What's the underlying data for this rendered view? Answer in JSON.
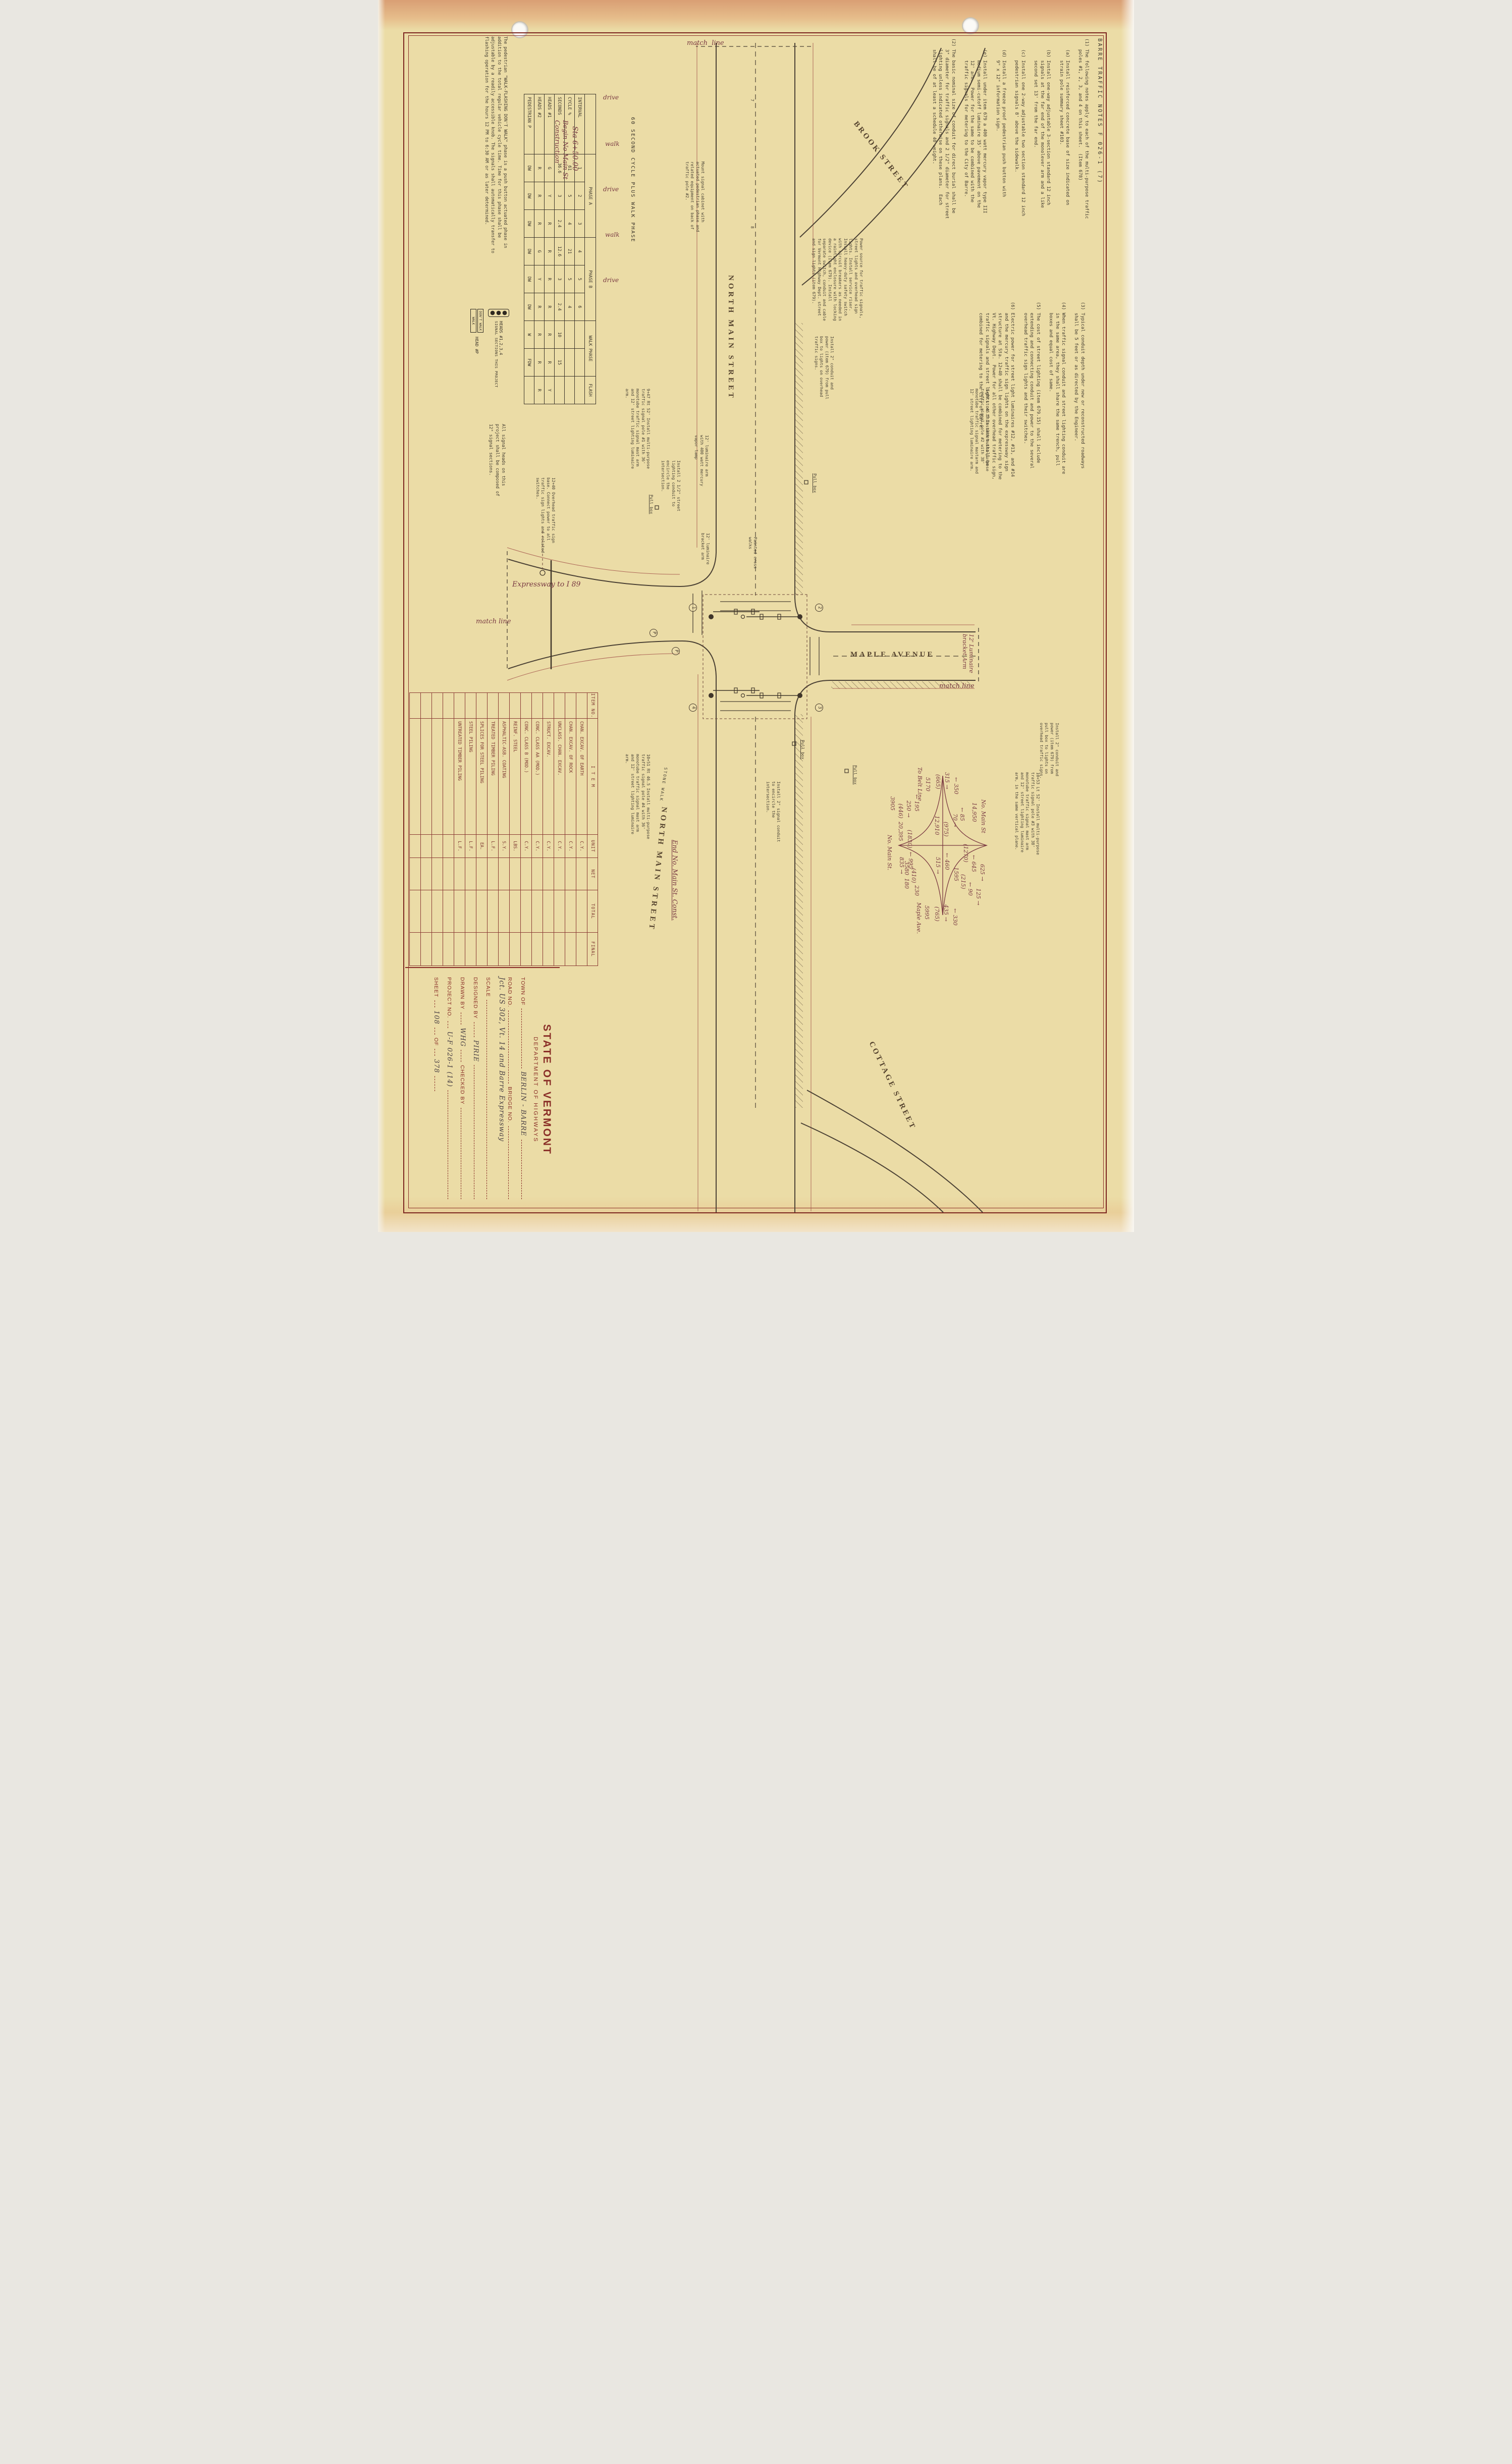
{
  "sheet": {
    "accent_maroon": "#8a2f28",
    "paper": "#ebdca6",
    "ink": "#433c30",
    "hand_ink": "#793a43"
  },
  "notes": {
    "title": "BARRE  TRAFFIC  NOTES        F 026-1 (7)",
    "col1": "(1) The following notes apply to each of the multi-purpose traffic\n    poles #1, 2, 3, and 4 on this sheet.  (Item 678)\n\n    (a) Install reinforced concrete base of size indicated on\n        strain pole summary sheet #103.\n\n    (b) Install one-way adjustable 3-section standard 12 inch\n        signals at the far end of the monolever arm and a like\n        second set 13' from the far end.\n\n    (c) Install one 2-way adjustable two section standard 12 inch\n        pedestrian signals 8' above the sidewalk.\n\n    (d) Install a freeze proof pedestrian push button with\n        9\" x 12\" information sign.\n\n    (e) Install under item 679 a 400 watt mercury vapor type III\n        medium semi-cutoff luminaire 35' above pavement on the\n        12' arm.  Power for the same to be combined with the\n        traffic signals for metering to the City of Barre.\n\n(2) The basic nominal size of conduit for direct burial shall be\n    3\" diameter for traffic signals and 2 1/2\" diameter for street\n    lighting unless indicated otherwise on these plans.  Each\n    shall be of at least a schedule 40 weight.",
    "col2": "(3) Typical conduit depth under new or reconstructed roadways\n    shall be 5 feet or as directed by the Engineer.\n\n(4) When traffic signal conduit and street lighting conduit are\n    in the same area, they shall share the same trench, pull\n    boxes and equal cost of same.\n\n(5) The cost of street lighting (item 679.15) shall include\n    extending and connecting conduit and power to the several\n    overhead traffic sign lights and their switches.\n\n(6) Electric power for street light luminaires #12, #13, and #14\n    and the mercury traffic sign lights on the expressway sign\n    structure at Sta. 12+40 shall be combined for metering to the\n    Vt. Highway Dept.  Power for all other overhead traffic sign,\n    traffic signals and street lights on this sheet shall be\n    combined for metering to the City of Barre."
  },
  "cycle_table": {
    "title": "60 SECOND CYCLE PLUS WALK PHASE",
    "groups": [
      "PHASE A",
      "PHASE B",
      "WALK PHASE",
      "FLASH"
    ],
    "row_labels": [
      "INTERVAL",
      "CYCLE %",
      "SECONDS",
      "HEADS #1",
      "HEADS #2",
      "PEDESTRIAN  P"
    ],
    "intervals": [
      "1",
      "2",
      "3",
      "4",
      "5",
      "6",
      "",
      "",
      ""
    ],
    "cycle_pct": [
      "61",
      "5",
      "4",
      "21",
      "5",
      "4",
      "",
      "",
      ""
    ],
    "seconds": [
      "36.6",
      "3",
      "2.4",
      "12.6",
      "3",
      "2.4",
      "10",
      "15",
      ""
    ],
    "heads1": [
      "G",
      "Y",
      "R",
      "R",
      "R",
      "R",
      "R",
      "R",
      "Y"
    ],
    "heads2": [
      "R",
      "R",
      "R",
      "G",
      "Y",
      "R",
      "R",
      "R",
      "R"
    ],
    "pedestrian": [
      "DW",
      "DW",
      "DW",
      "DW",
      "DW",
      "DW",
      "W",
      "FDW",
      ""
    ]
  },
  "ped_note": "The pedestrian \"WALK-FLASHING DON'T WALK\" phase is a push button actuated phase in addition to the total regular vehicle cycle time.  Time for this phase shall be adjustable by a readily accessible knob.  The signals shall automatically transfer to flashing operation for the hours 12 PM to 6:30 AM or as later determined.",
  "heads_note": "All signal heads on this project shall be composed of 12\" signal sections.",
  "legend": {
    "heads_label": "HEADS #1,2,3,4",
    "heads_sub": "SIGNAL SECTIONS THIS PROJECT",
    "dont_walk": "DON'T WALK",
    "walk": "WALK",
    "ped_label": "HEAD #P"
  },
  "items_table": {
    "headers": [
      "ITEM NO.",
      "I T E M",
      "UNIT",
      "NET",
      "TOTAL",
      "FINAL"
    ],
    "rows": [
      [
        "",
        "CHAN. EXCAV. OF EARTH",
        "C.Y.",
        "",
        "",
        ""
      ],
      [
        "",
        "CHAN. EXCAV. OF ROCK",
        "C.Y.",
        "",
        "",
        ""
      ],
      [
        "",
        "UNCLASS. CHAN. EXCAV.",
        "C.Y.",
        "",
        "",
        ""
      ],
      [
        "",
        "STRUCT. EXCAV.",
        "C.Y.",
        "",
        "",
        ""
      ],
      [
        "",
        "CONC. CLASS AA (MOD.)",
        "C.Y.",
        "",
        "",
        ""
      ],
      [
        "",
        "CONC. CLASS B (MOD.)",
        "C.Y.",
        "",
        "",
        ""
      ],
      [
        "",
        "REINF. STEEL",
        "LBS.",
        "",
        "",
        ""
      ],
      [
        "",
        "ASPHALTIC-ASB. COATING",
        "S.Y.",
        "",
        "",
        ""
      ],
      [
        "",
        "TREATED TIMBER PILING",
        "L.F.",
        "",
        "",
        ""
      ],
      [
        "",
        "SPLICES FOR STEEL PILING",
        "EA.",
        "",
        "",
        ""
      ],
      [
        "",
        "STEEL PILING",
        "L.F.",
        "",
        "",
        ""
      ],
      [
        "",
        "UNTREATED TIMBER PILING",
        "L.F.",
        "",
        "",
        ""
      ],
      [
        "",
        "",
        "",
        "",
        "",
        ""
      ],
      [
        "",
        "",
        "",
        "",
        "",
        ""
      ],
      [
        "",
        "",
        "",
        "",
        "",
        ""
      ],
      [
        "",
        "",
        "",
        "",
        "",
        ""
      ]
    ]
  },
  "title_block": {
    "state": "STATE OF VERMONT",
    "dept": "DEPARTMENT OF HIGHWAYS",
    "town_label": "TOWN OF",
    "town_value": "BERLIN - BARRE",
    "road_label": "ROAD NO.",
    "bridge_label": "BRIDGE NO.",
    "route_value": "Jct. US 302, Vt. 14 and Barre Expressway",
    "scale_label": "SCALE",
    "designed_label": "DESIGNED BY",
    "designed_value": "PIRIE",
    "drawn_label": "DRAWN BY",
    "drawn_value": "WHG",
    "checked_label": "CHECKED BY",
    "project_label": "PROJECT NO.",
    "project_value": "U-F 026-1 (14)",
    "sheet_label": "SHEET",
    "sheet_value": "108",
    "of_label": "OF",
    "total_sheets": "378"
  },
  "traffic_counts": {
    "legs": [
      {
        "name": "No. Main St",
        "adt": "14,950",
        "dhv": "(1270)",
        "flows": [
          "625",
          "645"
        ]
      },
      {
        "name": "Maple Ave.",
        "adt": "5995",
        "dhv": "(765)",
        "flows": [
          "330",
          "435"
        ]
      },
      {
        "name": "No. Main St.",
        "adt": "20,395",
        "dhv": "(1830)",
        "flows": [
          "995",
          "835"
        ]
      },
      {
        "name": "To Belt Line",
        "adt": "5170",
        "dhv": "(665)",
        "flows": [
          "350",
          "315"
        ]
      }
    ],
    "movements": [
      {
        "path": "through N-S",
        "values": [
          "460",
          "515",
          "(975)",
          "12,910"
        ]
      },
      {
        "path": "NE corner",
        "values": [
          "125",
          "90",
          "(215)",
          "1595"
        ]
      },
      {
        "path": "SE corner",
        "values": [
          "230",
          "180",
          "(410)",
          "3580"
        ]
      },
      {
        "path": "SW corner",
        "values": [
          "195",
          "250",
          "(446)",
          "3905"
        ]
      },
      {
        "path": "NW corner",
        "values": [
          "85",
          "70"
        ]
      }
    ]
  },
  "labels": [
    {
      "t": "BROOK STREET",
      "c": "street",
      "s": "left:225px;top:492px;transform:rotate(-38deg);letter-spacing:4px"
    },
    {
      "t": "NORTH MAIN STREET",
      "c": "street",
      "s": "left:545px;top:790px;letter-spacing:5px"
    },
    {
      "t": "NORTH MAIN STREET",
      "c": "street",
      "s": "left:1598px;top:935px;transform:rotate(6deg);letter-spacing:5px"
    },
    {
      "t": "MAPLE AVENUE",
      "c": "street",
      "s": "left:1288px;top:562px;transform:rotate(-90deg);transform-origin:0 0;letter-spacing:4px"
    },
    {
      "t": "COTTAGE STREET",
      "c": "street",
      "s": "left:2055px;top:470px;transform:rotate(-26deg);letter-spacing:4px"
    },
    {
      "t": "Expressway to I 89",
      "c": "hand",
      "s": "left:1150px;top:1232px;transform:rotate(-90deg);transform-origin:0 0;font-size:14px"
    },
    {
      "t": "match  line",
      "c": "hand",
      "s": "left:78px;top:886px;transform:rotate(-90deg);transform-origin:0 0;font-size:13px"
    },
    {
      "t": "match line",
      "c": "hand",
      "s": "left:1352px;top:386px;transform:rotate(-90deg);transform-origin:0 0;font-size:13px"
    },
    {
      "t": "match line",
      "c": "hand",
      "s": "left:1224px;top:1304px;transform:rotate(-90deg);transform-origin:0 0;font-size:13px"
    },
    {
      "t": "Sta 6+50.00",
      "c": "hand",
      "s": "left:250px;top:1100px;font-size:14px"
    },
    {
      "t": "Begin No Main St Construction",
      "c": "hand",
      "s": "left:238px;top:1120px;font-size:13px;width:170px;white-space:normal"
    },
    {
      "t": "End No. Main St. Const.",
      "c": "hand",
      "s": "left:1664px;top:903px;font-size:13px;text-decoration:underline"
    },
    {
      "t": "drive",
      "c": "hand",
      "s": "left:186px;top:1052px;transform:rotate(-90deg);transform-origin:0 0"
    },
    {
      "t": "walk",
      "c": "hand",
      "s": "left:278px;top:1048px;transform:rotate(-90deg);transform-origin:0 0"
    },
    {
      "t": "drive",
      "c": "hand",
      "s": "left:368px;top:1052px;transform:rotate(-90deg);transform-origin:0 0"
    },
    {
      "t": "walk",
      "c": "hand",
      "s": "left:458px;top:1048px;transform:rotate(-90deg);transform-origin:0 0"
    },
    {
      "t": "drive",
      "c": "hand",
      "s": "left:548px;top:1052px;transform:rotate(-90deg);transform-origin:0 0"
    },
    {
      "t": "12' Luminaire bracket Arm",
      "c": "hand",
      "s": "left:1256px;top:316px;width:88px;font-size:11px;white-space:normal;line-height:1.2"
    },
    {
      "t": "9+49 Lt 45.5  Install multi-purpose traffic signal pole #2 with 38' monotube traffic signal mastarm and 12' street lighting luminaire arm.",
      "c": "typed",
      "s": "left:770px;top:286px;width:172px"
    },
    {
      "t": "Install 2\" conduit and power (item 679) from pull box to lights on overhead traffic signs.",
      "c": "typed",
      "s": "left:1432px;top:148px;width:122px"
    },
    {
      "t": "10+53 Lt 52'  Install multi-purpose traffic signal pole #3 with 38' monotube traffic signal mast arm and 12' street lighting luminaire arm, in the same vertical plane.",
      "c": "typed",
      "s": "left:1530px;top:186px;width:172px"
    },
    {
      "t": "Power source for traffic signals, street lights and overhead sign lights. Install service riser. Install heavy-duty safety switch with circuit breakers as needed in a raintight enclosure with locking device (item 679). Install separate switch, conduit and cable for Vermont Highway Dept. street and sign lights (item 679).",
      "c": "typed",
      "s": "left:472px;top:536px;width:168px"
    },
    {
      "t": "Mount signal cabinet with actuated pedestrian phase and related equipment on back of traffic pole #2.",
      "c": "typed",
      "s": "left:320px;top:850px;width:162px"
    },
    {
      "t": "Install 2\" conduit and power (item 679) from pull box to lights on overhead traffic signs.",
      "c": "typed",
      "s": "left:666px;top:594px;width:130px"
    },
    {
      "t": "Install 2 1/2\" street lighting conduit to encircle the intersection.",
      "c": "typed",
      "s": "left:912px;top:898px;width:122px"
    },
    {
      "t": "Install 2\" signal conduit to encircle the intersection.",
      "c": "typed",
      "s": "left:1548px;top:700px;width:126px"
    },
    {
      "t": "9+47 Rt 52'  Install multi-purpose traffic signal pole #1 with 36' monotube traffic signal mast arm and 12' street lighting luminaire arm.",
      "c": "typed",
      "s": "left:770px;top:958px;width:172px"
    },
    {
      "t": "10+51 Rt 46.5  Install multi-purpose traffic signal pole #4 with 36' monotube traffic signal mast arm and 12' street lighting luminaire arm.",
      "c": "typed",
      "s": "left:1494px;top:958px;width:172px"
    },
    {
      "t": "12+40 Overhead traffic sign base.  Connect power to all traffic sign lights and related switches.",
      "c": "typed",
      "s": "left:946px;top:1146px;width:152px"
    },
    {
      "t": "Painted cross walks",
      "c": "typed",
      "s": "left:1064px;top:746px;width:64px"
    },
    {
      "t": "Pull box",
      "c": "typed",
      "s": "left:980px;top:952px;text-decoration:underline"
    },
    {
      "t": "Pull box",
      "c": "typed",
      "s": "left:938px;top:628px;text-decoration:underline"
    },
    {
      "t": "Pull box",
      "c": "typed",
      "s": "left:1516px;top:548px;text-decoration:underline"
    },
    {
      "t": "Pull box",
      "c": "typed",
      "s": "left:1466px;top:652px;text-decoration:underline"
    },
    {
      "t": "12' luminaire bracket arm",
      "c": "typed",
      "s": "left:1056px;top:840px;width:84px"
    },
    {
      "t": "12' luminaire arm with 400 watt mercury vapor lamp",
      "c": "typed",
      "s": "left:862px;top:842px;width:104px"
    },
    {
      "t": "STONE WALK",
      "c": "typed",
      "s": "left:1520px;top:928px;transform:rotate(8deg);letter-spacing:2px"
    },
    {
      "t": "7",
      "c": "typed",
      "s": "left:196px;top:752px"
    },
    {
      "t": "8",
      "c": "typed",
      "s": "left:448px;top:752px"
    },
    {
      "t": "2",
      "c": "circ",
      "s": "left:1196px;top:616px"
    },
    {
      "t": "1",
      "c": "circ",
      "s": "left:1196px;top:866px"
    },
    {
      "t": "3",
      "c": "circ",
      "s": "left:1394px;top:616px"
    },
    {
      "t": "4",
      "c": "circ",
      "s": "left:1394px;top:866px"
    },
    {
      "t": "P",
      "c": "circ",
      "s": "left:1282px;top:900px"
    },
    {
      "t": "P",
      "c": "circ",
      "s": "left:1246px;top:944px"
    },
    {
      "t": "No. Main St",
      "c": "hand",
      "s": "left:1584px;top:292px;font-size:11px"
    },
    {
      "t": "14,950",
      "c": "hand",
      "s": "left:1590px;top:310px;font-size:11px"
    },
    {
      "t": "625 →",
      "c": "hand",
      "s": "left:1712px;top:294px;font-size:11px"
    },
    {
      "t": "← 645",
      "c": "hand",
      "s": "left:1694px;top:311px;font-size:11px"
    },
    {
      "t": "(1270)",
      "c": "hand",
      "s": "left:1672px;top:327px;font-size:11px"
    },
    {
      "t": "← 460",
      "c": "hand",
      "s": "left:1690px;top:364px;font-size:11px"
    },
    {
      "t": "515 →",
      "c": "hand",
      "s": "left:1698px;top:382px;font-size:11px"
    },
    {
      "t": "(975)",
      "c": "hand",
      "s": "left:1628px;top:366px;font-size:11px"
    },
    {
      "t": "12,910",
      "c": "hand",
      "s": "left:1616px;top:384px;font-size:11px"
    },
    {
      "t": "← 350",
      "c": "hand",
      "s": "left:1540px;top:346px;font-size:11px"
    },
    {
      "t": "315 →",
      "c": "hand",
      "s": "left:1530px;top:364px;font-size:11px"
    },
    {
      "t": "(665)",
      "c": "hand",
      "s": "left:1534px;top:382px;font-size:11px"
    },
    {
      "t": "5170",
      "c": "hand",
      "s": "left:1540px;top:402px;font-size:11px"
    },
    {
      "t": "To Belt Line",
      "c": "hand",
      "s": "left:1520px;top:418px;font-size:11px"
    },
    {
      "t": "← 330",
      "c": "hand",
      "s": "left:1800px;top:348px;font-size:11px"
    },
    {
      "t": "435 →",
      "c": "hand",
      "s": "left:1792px;top:366px;font-size:11px"
    },
    {
      "t": "(765)",
      "c": "hand",
      "s": "left:1796px;top:384px;font-size:11px"
    },
    {
      "t": "5995",
      "c": "hand",
      "s": "left:1794px;top:404px;font-size:11px"
    },
    {
      "t": "Maple Ave.",
      "c": "hand",
      "s": "left:1788px;top:420px;font-size:11px"
    },
    {
      "t": "← 995",
      "c": "hand",
      "s": "left:1688px;top:436px;font-size:11px"
    },
    {
      "t": "835 →",
      "c": "hand",
      "s": "left:1698px;top:454px;font-size:11px"
    },
    {
      "t": "(1830)",
      "c": "hand",
      "s": "left:1644px;top:438px;font-size:11px"
    },
    {
      "t": "20,395",
      "c": "hand",
      "s": "left:1628px;top:456px;font-size:11px"
    },
    {
      "t": "No. Main St.",
      "c": "hand",
      "s": "left:1654px;top:478px;font-size:11px"
    },
    {
      "t": "125 →",
      "c": "hand",
      "s": "left:1760px;top:302px;font-size:11px"
    },
    {
      "t": "← 90",
      "c": "hand",
      "s": "left:1748px;top:318px;font-size:11px"
    },
    {
      "t": "(215)",
      "c": "hand",
      "s": "left:1732px;top:332px;font-size:11px"
    },
    {
      "t": "1595",
      "c": "hand",
      "s": "left:1718px;top:346px;font-size:11px"
    },
    {
      "t": "230",
      "c": "hand",
      "s": "left:1754px;top:424px;font-size:11px"
    },
    {
      "t": "180",
      "c": "hand",
      "s": "left:1740px;top:444px;font-size:11px"
    },
    {
      "t": "(410)",
      "c": "hand",
      "s": "left:1720px;top:430px;font-size:11px"
    },
    {
      "t": "3580",
      "c": "hand",
      "s": "left:1706px;top:444px;font-size:11px"
    },
    {
      "t": "← 195",
      "c": "hand",
      "s": "left:1574px;top:424px;font-size:11px"
    },
    {
      "t": "250 →",
      "c": "hand",
      "s": "left:1586px;top:440px;font-size:11px"
    },
    {
      "t": "(446)",
      "c": "hand",
      "s": "left:1592px;top:456px;font-size:11px"
    },
    {
      "t": "3905",
      "c": "hand",
      "s": "left:1578px;top:472px;font-size:11px"
    },
    {
      "t": "← 85",
      "c": "hand",
      "s": "left:1600px;top:334px;font-size:11px"
    },
    {
      "t": "70 →",
      "c": "hand",
      "s": "left:1612px;top:348px;font-size:11px"
    }
  ]
}
